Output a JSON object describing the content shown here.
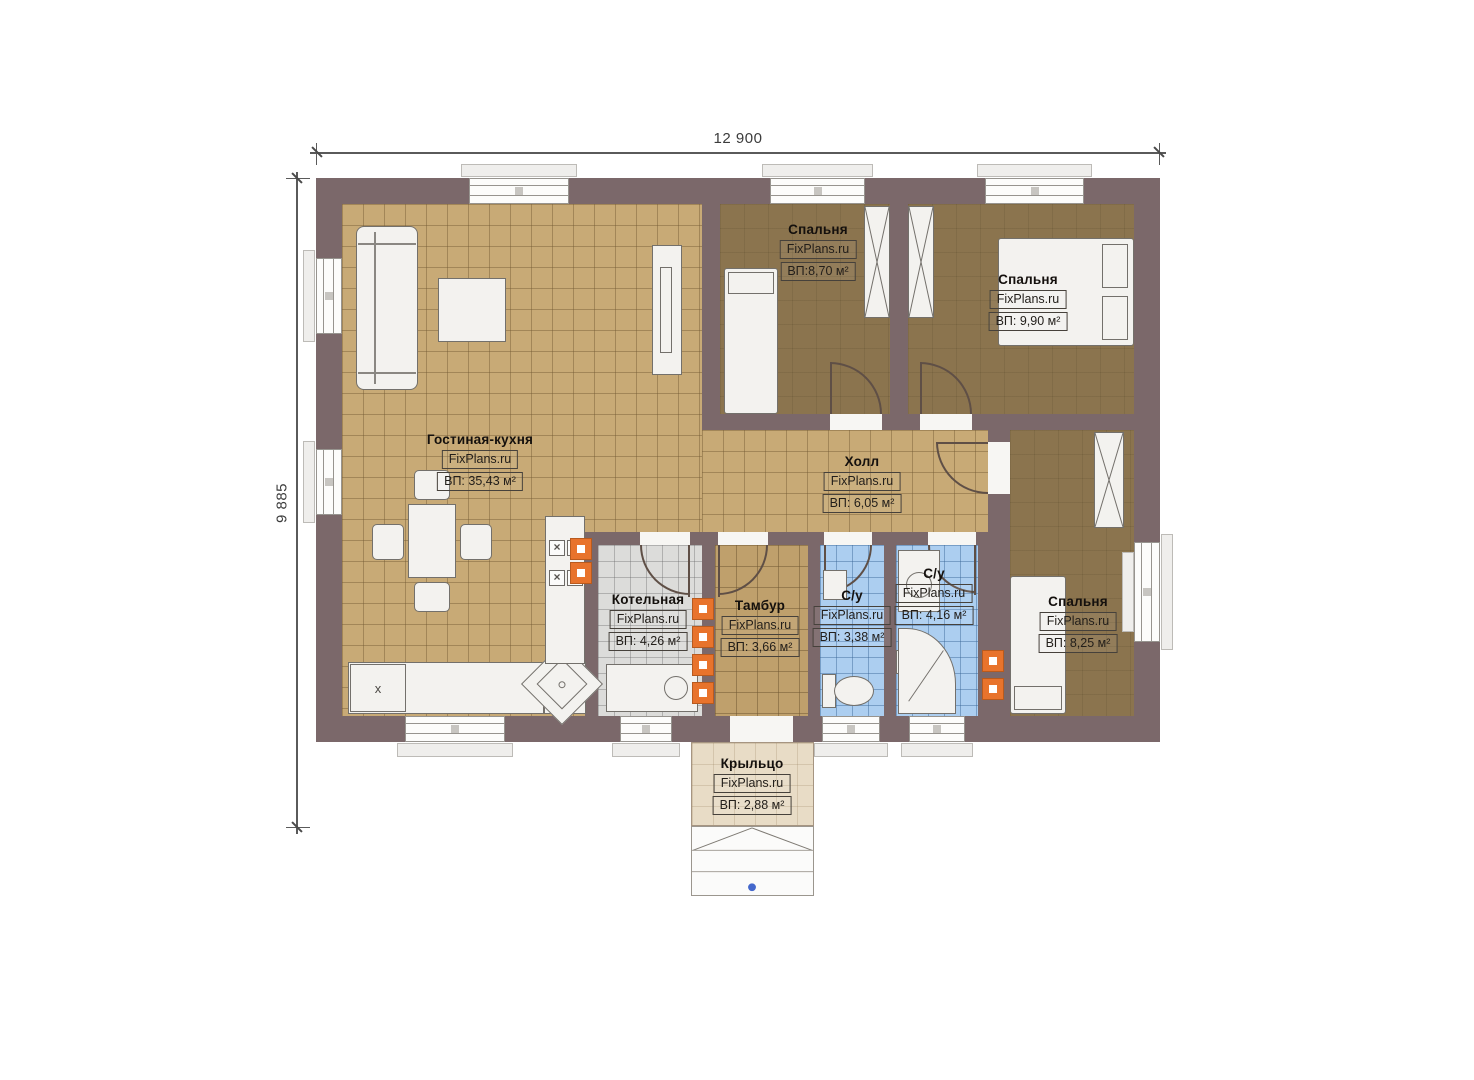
{
  "plan": {
    "brand": "FixPlans.ru",
    "dimensions": {
      "width_label": "12 900",
      "height_label": "9 885"
    },
    "rooms": [
      {
        "id": "living",
        "name": "Гостиная-кухня",
        "brand": "FixPlans.ru",
        "area": "ВП: 35,43 м²"
      },
      {
        "id": "bedroom1",
        "name": "Спальня",
        "brand": "FixPlans.ru",
        "area": "ВП:8,70 м²"
      },
      {
        "id": "bedroom2",
        "name": "Спальня",
        "brand": "FixPlans.ru",
        "area": "ВП: 9,90 м²"
      },
      {
        "id": "hall",
        "name": "Холл",
        "brand": "FixPlans.ru",
        "area": "ВП: 6,05 м²"
      },
      {
        "id": "boiler",
        "name": "Котельная",
        "brand": "FixPlans.ru",
        "area": "ВП: 4,26 м²"
      },
      {
        "id": "vestibule",
        "name": "Тамбур",
        "brand": "FixPlans.ru",
        "area": "ВП: 3,66 м²"
      },
      {
        "id": "wc1",
        "name": "С/у",
        "brand": "FixPlans.ru",
        "area": "ВП: 3,38 м²"
      },
      {
        "id": "wc2",
        "name": "С/у",
        "brand": "FixPlans.ru",
        "area": "ВП: 4,16 м²"
      },
      {
        "id": "bedroom3",
        "name": "Спальня",
        "brand": "FixPlans.ru",
        "area": "ВП: 8,25 м²"
      },
      {
        "id": "porch",
        "name": "Крыльцо",
        "brand": "FixPlans.ru",
        "area": "ВП: 2,88 м²"
      }
    ],
    "kitchen_appliance_label": "x",
    "colors": {
      "wall": "#7b686a",
      "living_floor": "#c8aa76",
      "vestibule_floor": "#bfa06c",
      "bedroom_floor": "#8b744e",
      "bath_floor": "#accef0",
      "boiler_floor": "#dcdcda",
      "porch_floor": "#e8dcc6",
      "vent_accent": "#e8732c",
      "entry_marker": "#4468cc"
    }
  }
}
